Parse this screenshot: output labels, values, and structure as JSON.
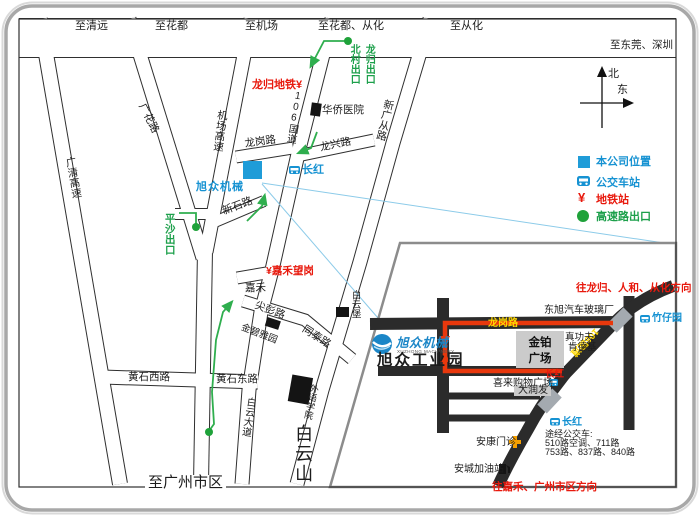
{
  "compass": {
    "north": "北",
    "east": "东"
  },
  "top_roads": {
    "qingyuan": "至清远",
    "huadu": "至花都",
    "jichang": "至机场",
    "huadu_conghua": "至花都、从化",
    "conghua": "至从化",
    "dongguan_shenzhen": "至东莞、深圳"
  },
  "main_map": {
    "roads": {
      "guangqing_expwy": "广清高速",
      "guanghua_rd": "广花路",
      "jichang_expwy": "机场高速",
      "guodao_106": "106国道",
      "xinguangcong_rd": "新广从路",
      "longgang_rd": "龙岗路",
      "longxing_rd": "龙兴路",
      "xinshi_rd": "新石路",
      "jianpeng_rd": "尖彭路",
      "tongtai_rd": "同泰路",
      "huangshi_west_rd": "黄石西路",
      "huangshi_east_rd": "黄石东路",
      "baiyun_avenue": "白云大道",
      "to_guangzhou": "至广州市区"
    },
    "places": {
      "huaqiao_hospital": "华侨医院",
      "xuzhong_machinery": "旭众机械",
      "jiahe": "嘉禾",
      "baiyunbao": "白云堡",
      "jinbiyayuan": "金碧雅园",
      "waiyu_college": "外语学院",
      "baiyunshan": "白云山"
    },
    "stations": {
      "changhong": "长红",
      "longgui_metro": "龙归地铁",
      "jiahewanggang": "嘉禾望岗"
    },
    "exits": {
      "beicun": "北村出口",
      "longgui": "龙归出口",
      "pingsha": "平沙出口"
    }
  },
  "legend": {
    "company": "本公司位置",
    "bus": "公交车站",
    "metro": "地铁站",
    "highway_exit": "高速路出口",
    "metro_glyph": "¥"
  },
  "inset": {
    "to_north": "往龙归、人和、从化方向",
    "to_south": "往嘉禾、广州市区方向",
    "dongxu_glass": "东旭汽车玻璃厂",
    "zhuziyuan": "竹仔园",
    "longgang_road": "龙岗路",
    "guodao_106": "106国道",
    "jinbo_line1": "金铂",
    "jinbo_line2": "广场",
    "zhengongfu": "真功夫",
    "kendeji": "肯德基",
    "brand": "旭众机械",
    "brand_sub": "XUZHONG MACHINERY",
    "industrial_park": "旭众工业园",
    "changhong_red": "长红",
    "changhong_blue": "长红",
    "xilai_mall": "喜来购物广场",
    "darunfa": "大润发",
    "bus_title": "途经公交车:",
    "bus_line1": "510路空调、711路",
    "bus_line2": "753路、837路、840路",
    "ankang_clinic": "安康门诊",
    "ancheng_gas": "安城加油站"
  }
}
